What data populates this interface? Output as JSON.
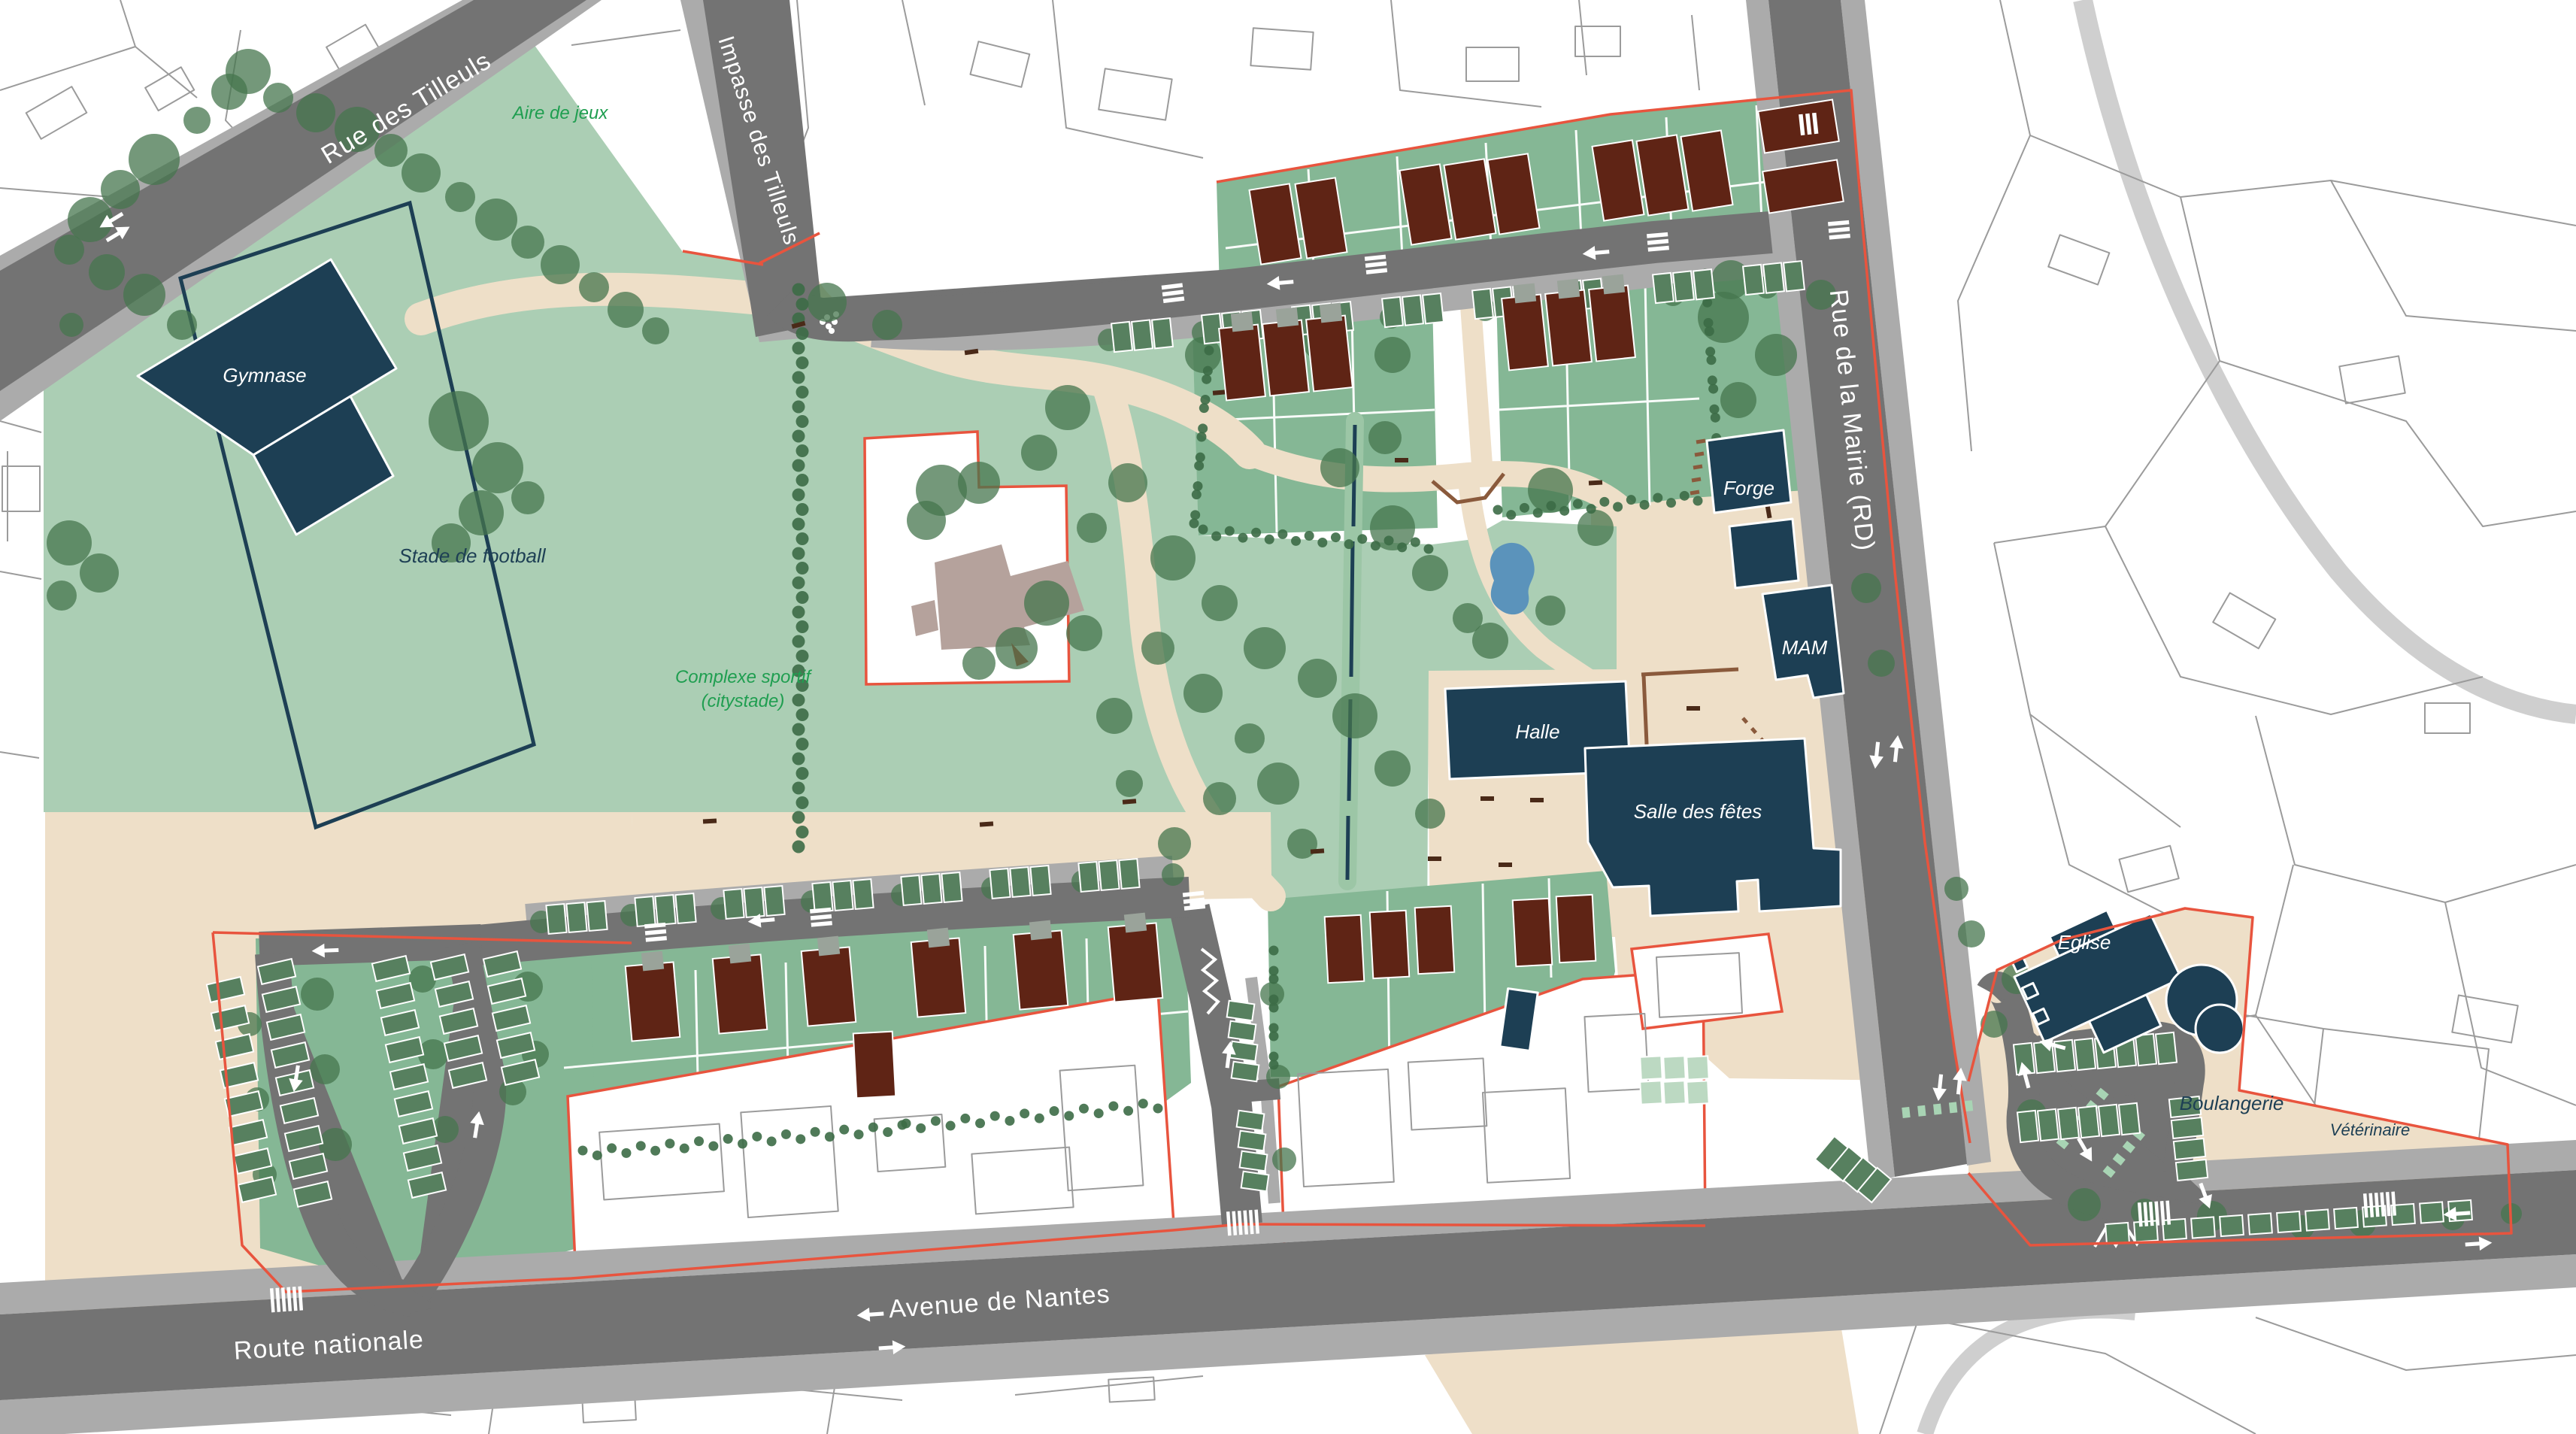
{
  "map": {
    "title": "Plan d'aménagement du centre-bourg",
    "streets": {
      "rue_des_tilleuls": "Rue des Tilleuls",
      "impasse_des_tilleuls": "Impasse des Tilleuls",
      "rue_de_la_mairie": "Rue de la Mairie (RD)",
      "avenue_de_nantes": "Avenue de Nantes",
      "route_nationale": "Route nationale"
    },
    "places": {
      "aire_de_jeux": "Aire de jeux",
      "stade_de_football": "Stade de football",
      "complexe_sportif_line1": "Complexe sportif",
      "complexe_sportif_line2": "(citystade)",
      "gymnase": "Gymnase",
      "forge": "Forge",
      "mam": "MAM",
      "halle": "Halle",
      "salle_des_fetes": "Salle des fêtes",
      "eglise": "Eglise",
      "boulangerie": "Boulangerie",
      "veterinaire": "Vétérinaire"
    },
    "colors": {
      "road": "#737373",
      "roadlight": "#ababab",
      "park": "#abceb4",
      "lot": "#85b795",
      "path": "#eedfc8",
      "navy": "#1d3f54",
      "house": "#5f2415",
      "stall": "#57805f",
      "tree": "#45754d",
      "treedark": "#3c6b46",
      "pond": "#5b93bb",
      "boundary": "#e8543e",
      "wall": "#8a5a3c",
      "cad": "#9b9b9b",
      "labelgreen": "#1f9e50"
    }
  }
}
